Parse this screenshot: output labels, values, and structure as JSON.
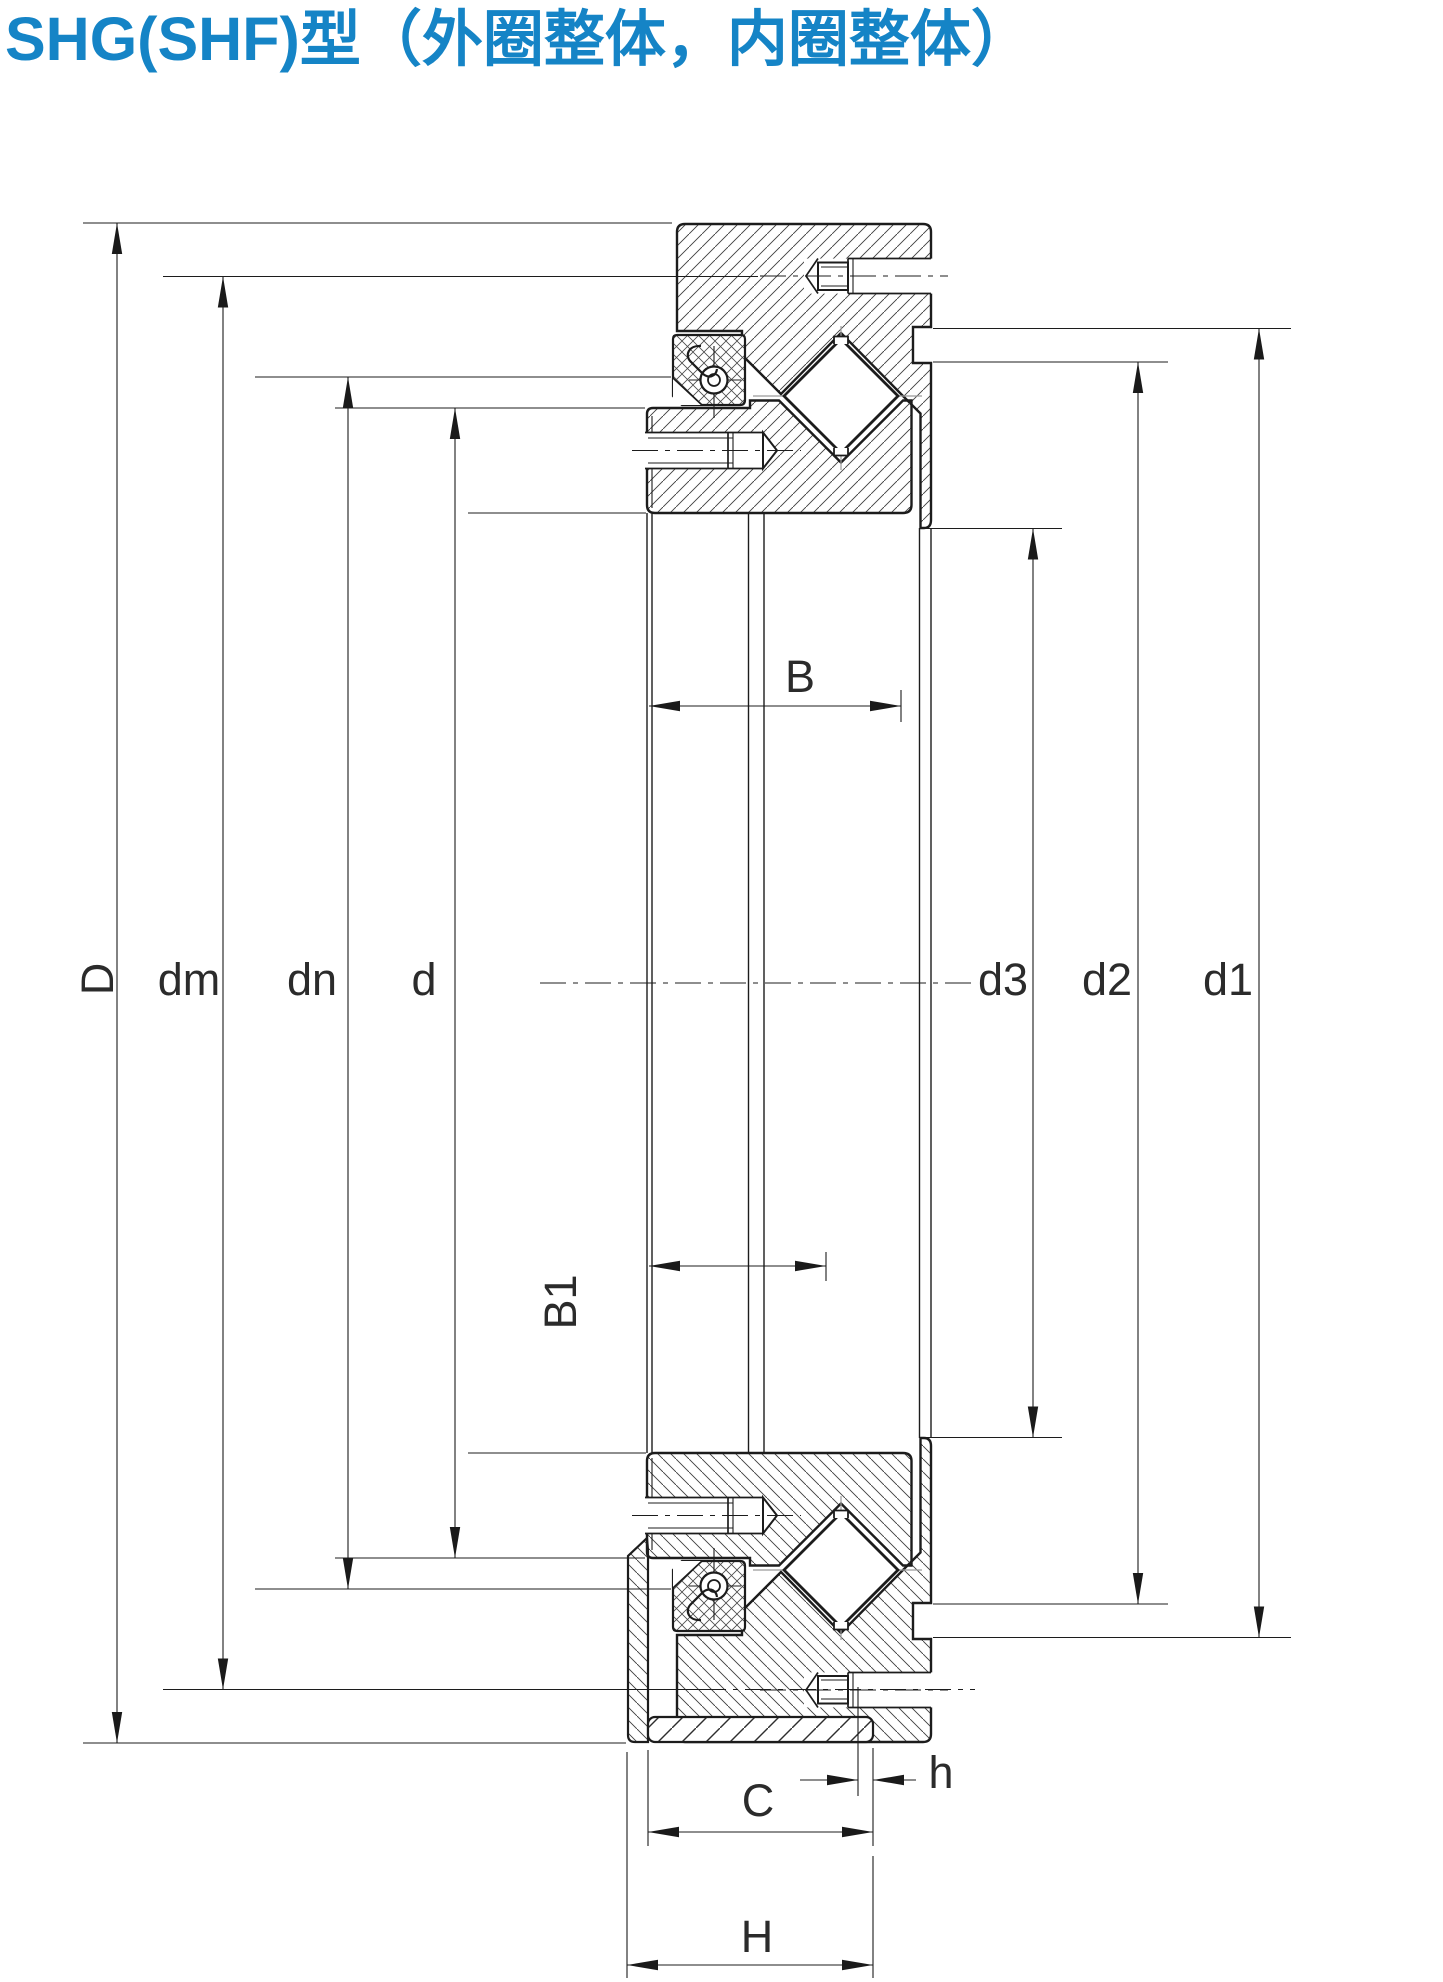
{
  "title": {
    "text": "SHG(SHF)型（外圈整体，内圈整体）",
    "color": "#1584c6"
  },
  "drawing": {
    "kind": "crossed-roller-bearing cross-section, outer ring integral, inner ring integral",
    "line_color": "#1c1c1c",
    "dimension_labels": {
      "D": "D",
      "dm": "dm",
      "dn": "dn",
      "d": "d",
      "B": "B",
      "B1": "B1",
      "d3": "d3",
      "d2": "d2",
      "d1": "d1",
      "C": "C",
      "h": "h",
      "H": "H"
    }
  }
}
